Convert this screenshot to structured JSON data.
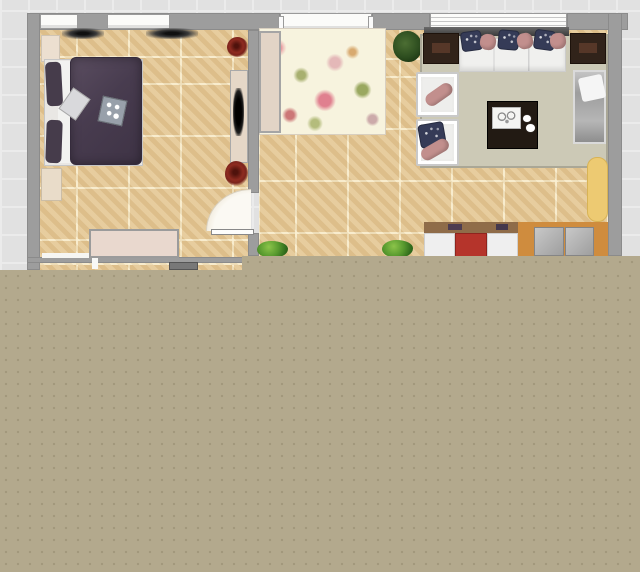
{
  "canvas": {
    "width": 640,
    "height": 572
  },
  "colors": {
    "background": "#e1e1e1",
    "background_grid": "#ebebeb",
    "wall": "#9d9d9d",
    "floor_tile": "#e4c795",
    "tile_grout": "#faeece",
    "unrendered_area": "#b3a98d",
    "unrendered_dots": "#a1977b",
    "bed_duvet": "#483c4f",
    "sofa_white": "#f0f0ee",
    "pillow_navy": "#353b57",
    "pillow_pink": "#c28f8d",
    "cabinet_red": "#b5342b",
    "counter_wood": "#cf8c3e",
    "board_yellow": "#edca72",
    "rug_sage": "#ccc9b6",
    "rug_floral_base": "#f7f3de"
  },
  "layers": [
    {
      "name": "floors",
      "items": [
        {
          "n": "bedroom-floor",
          "c": "tile",
          "x": 40,
          "y": 28,
          "w": 208,
          "h": 235,
          "int": false
        },
        {
          "n": "living-room-floor",
          "c": "tile",
          "x": 259,
          "y": 30,
          "w": 349,
          "h": 226,
          "int": false
        },
        {
          "n": "hallway-floor-sliver",
          "c": "tile",
          "x": 40,
          "y": 263,
          "w": 208,
          "h": 7,
          "int": false
        }
      ]
    },
    {
      "name": "walls",
      "items": [
        {
          "n": "left-wall",
          "c": "wall",
          "x": 27,
          "y": 13,
          "w": 13,
          "h": 257,
          "int": false
        },
        {
          "n": "top-wall-bedroom",
          "c": "wall",
          "x": 40,
          "y": 13,
          "w": 240,
          "h": 17,
          "int": false
        },
        {
          "n": "top-wall-living",
          "c": "wall",
          "x": 372,
          "y": 13,
          "w": 58,
          "h": 17,
          "int": false
        },
        {
          "n": "top-wall-right",
          "c": "wall",
          "x": 567,
          "y": 13,
          "w": 61,
          "h": 17,
          "int": false
        },
        {
          "n": "right-wall",
          "c": "wall",
          "x": 608,
          "y": 13,
          "w": 14,
          "h": 243,
          "int": false
        },
        {
          "n": "divider-wall-upper",
          "c": "wall",
          "x": 248,
          "y": 30,
          "w": 11,
          "h": 163,
          "int": false
        },
        {
          "n": "divider-wall-lower",
          "c": "wall",
          "x": 248,
          "y": 233,
          "w": 11,
          "h": 23,
          "int": false
        },
        {
          "n": "bedroom-bottom-wall",
          "c": "wall",
          "x": 27,
          "y": 257,
          "w": 221,
          "h": 6,
          "int": false
        }
      ]
    },
    {
      "name": "windows",
      "items": [
        {
          "n": "corner-window",
          "c": "window",
          "x": 40,
          "y": 14,
          "w": 38,
          "h": 15,
          "int": false
        },
        {
          "n": "bedroom-window",
          "c": "window",
          "x": 107,
          "y": 14,
          "w": 63,
          "h": 15,
          "int": false
        },
        {
          "n": "living-window-left",
          "c": "window",
          "x": 280,
          "y": 13,
          "w": 92,
          "h": 17,
          "int": false
        },
        {
          "n": "living-window-wide",
          "c": "window-lined",
          "x": 430,
          "y": 13,
          "w": 137,
          "h": 17,
          "int": false
        },
        {
          "n": "window-peg-left",
          "x": 278,
          "y": 16,
          "w": 6,
          "h": 17,
          "bg": "#fafafa",
          "bd": "1px solid #9a9a9a",
          "int": false
        },
        {
          "n": "window-peg-right",
          "x": 368,
          "y": 16,
          "w": 6,
          "h": 17,
          "bg": "#fafafa",
          "bd": "1px solid #9a9a9a",
          "int": false
        },
        {
          "n": "bedroom-low-window",
          "x": 42,
          "y": 253,
          "w": 47,
          "h": 5,
          "bg": "#f6f6f3",
          "int": false
        },
        {
          "n": "bottom-door-jamb",
          "x": 92,
          "y": 257,
          "w": 6,
          "h": 12,
          "bg": "#f8f8f6",
          "int": false
        }
      ]
    },
    {
      "name": "bedroom-furniture",
      "items": [
        {
          "n": "ceiling-lamp-left",
          "c": "sconce",
          "x": 62,
          "y": 28,
          "w": 42,
          "h": 11,
          "int": true
        },
        {
          "n": "ceiling-lamp-right",
          "c": "sconce",
          "x": 146,
          "y": 28,
          "w": 52,
          "h": 11,
          "int": true
        },
        {
          "n": "cream-cabinet",
          "x": 41,
          "y": 35,
          "w": 19,
          "h": 27,
          "bg": "#ecdfd0",
          "bd": "1px solid #cfc4b4",
          "int": true
        },
        {
          "n": "bed-mattress",
          "x": 44,
          "y": 59,
          "w": 99,
          "h": 107,
          "bg": "#e9e7e4",
          "bd": "1px solid #c6c6c6",
          "int": true
        },
        {
          "n": "bed-sheet",
          "x": 58,
          "y": 61,
          "w": 20,
          "h": 102,
          "bg": "#f2f2f0",
          "int": false
        },
        {
          "n": "bed-pillow-top",
          "x": 46,
          "y": 62,
          "w": 16,
          "h": 44,
          "bg": "#463c4b",
          "rad": "5px",
          "rot": -3,
          "int": true
        },
        {
          "n": "bed-pillow-bottom",
          "x": 46,
          "y": 120,
          "w": 16,
          "h": 43,
          "bg": "#463c4b",
          "rad": "5px",
          "rot": 2,
          "int": true
        },
        {
          "n": "bed-duvet",
          "c": "duvet",
          "x": 70,
          "y": 57,
          "w": 72,
          "h": 108,
          "int": true
        },
        {
          "n": "bed-diamond-pillow",
          "x": 64,
          "y": 91,
          "w": 21,
          "h": 26,
          "bg": "#d9d9dc",
          "bd": "1px solid #a8a8a8",
          "rot": 35,
          "int": true
        },
        {
          "n": "game-board",
          "c": "dots-board",
          "x": 100,
          "y": 98,
          "w": 25,
          "h": 26,
          "bg": "#98a0aa",
          "bd": "1px solid #6a7076",
          "rot": 12,
          "int": true
        },
        {
          "n": "nightstand",
          "x": 41,
          "y": 168,
          "w": 21,
          "h": 33,
          "bg": "#e9dcc9",
          "bd": "1px solid #cbbda6",
          "int": true
        },
        {
          "n": "console-table",
          "x": 230,
          "y": 70,
          "w": 18,
          "h": 93,
          "bg": "#e5d7c7",
          "bd": "1px solid #a9a9a9",
          "int": true
        },
        {
          "n": "black-vase",
          "c": "vase",
          "x": 233,
          "y": 88,
          "w": 11,
          "h": 48,
          "int": true
        },
        {
          "n": "red-flower-top",
          "c": "flower",
          "x": 227,
          "y": 37,
          "w": 21,
          "h": 20,
          "int": true
        },
        {
          "n": "red-flower-mid",
          "c": "flower",
          "x": 225,
          "y": 161,
          "w": 23,
          "h": 25,
          "int": true
        },
        {
          "n": "dresser",
          "x": 89,
          "y": 229,
          "w": 90,
          "h": 29,
          "bg": "#e9d8ce",
          "bd": "2px solid #9b9b9b",
          "int": true
        },
        {
          "n": "door-swing-arc",
          "c": "door-arc",
          "x": 206,
          "y": 189,
          "w": 45,
          "h": 42,
          "int": false
        },
        {
          "n": "door-leaf",
          "x": 211,
          "y": 229,
          "w": 43,
          "h": 6,
          "bg": "#fdfdfb",
          "bd": "1px solid #888",
          "int": true
        }
      ]
    },
    {
      "name": "living-furniture",
      "items": [
        {
          "n": "floral-rug",
          "c": "floral",
          "x": 259,
          "y": 28,
          "w": 127,
          "h": 107,
          "bd": "1px solid #d8cfc0",
          "int": true
        },
        {
          "n": "side-panel",
          "x": 259,
          "y": 31,
          "w": 22,
          "h": 102,
          "bg": "#e2d4c6",
          "bd": "2px solid #a5a5a5",
          "int": true
        },
        {
          "n": "potted-plant-top",
          "c": "plant-dark",
          "x": 393,
          "y": 31,
          "w": 29,
          "h": 31,
          "int": true
        },
        {
          "n": "sage-rug",
          "x": 420,
          "y": 34,
          "w": 188,
          "h": 134,
          "bg": "#ccc9b6",
          "bd": "2px solid #aaa796",
          "int": true
        },
        {
          "n": "sofa-back-rail",
          "c": "rail",
          "x": 424,
          "y": 27,
          "w": 145,
          "h": 9,
          "int": false
        },
        {
          "n": "end-table-left",
          "c": "endtable",
          "x": 423,
          "y": 33,
          "w": 36,
          "h": 31,
          "int": true
        },
        {
          "n": "end-table-right",
          "c": "endtable",
          "x": 570,
          "y": 33,
          "w": 36,
          "h": 31,
          "int": true
        },
        {
          "n": "sofa",
          "c": "sofa",
          "x": 459,
          "y": 38,
          "w": 107,
          "h": 34,
          "int": true
        },
        {
          "n": "sofa-pillow-navy-1",
          "c": "pillow-navy",
          "x": 461,
          "y": 31,
          "w": 21,
          "h": 20,
          "rot": -8,
          "int": true
        },
        {
          "n": "sofa-pillow-pink-1",
          "c": "pillow-pink",
          "x": 480,
          "y": 34,
          "w": 16,
          "h": 16,
          "rot": 10,
          "int": true
        },
        {
          "n": "sofa-pillow-navy-2",
          "c": "pillow-navy",
          "x": 498,
          "y": 30,
          "w": 21,
          "h": 20,
          "rot": 5,
          "int": true
        },
        {
          "n": "sofa-pillow-pink-2",
          "c": "pillow-pink",
          "x": 517,
          "y": 33,
          "w": 16,
          "h": 16,
          "rot": -12,
          "int": true
        },
        {
          "n": "sofa-pillow-navy-3",
          "c": "pillow-navy",
          "x": 534,
          "y": 30,
          "w": 21,
          "h": 20,
          "rot": 8,
          "int": true
        },
        {
          "n": "sofa-pillow-pink-3",
          "c": "pillow-pink",
          "x": 550,
          "y": 33,
          "w": 16,
          "h": 16,
          "rot": -5,
          "int": true
        },
        {
          "n": "armchair-top",
          "c": "chair",
          "x": 416,
          "y": 72,
          "w": 43,
          "h": 45,
          "int": true
        },
        {
          "n": "armchair-top-bolster",
          "c": "pillow-pink",
          "x": 424,
          "y": 88,
          "w": 30,
          "h": 13,
          "rot": -35,
          "int": true
        },
        {
          "n": "armchair-bottom",
          "c": "chair",
          "x": 416,
          "y": 119,
          "w": 43,
          "h": 47,
          "int": true
        },
        {
          "n": "armchair-bottom-pillow",
          "c": "pillow-navy",
          "x": 419,
          "y": 123,
          "w": 26,
          "h": 24,
          "rot": -10,
          "int": true
        },
        {
          "n": "armchair-bottom-bolster",
          "c": "pillow-pink",
          "x": 420,
          "y": 143,
          "w": 30,
          "h": 13,
          "rot": -30,
          "int": true
        },
        {
          "n": "coffee-table",
          "x": 487,
          "y": 101,
          "w": 51,
          "h": 48,
          "bg": "#221a13",
          "bd": "1px solid #000",
          "int": true
        },
        {
          "n": "coffee-table-tray",
          "c": "tray",
          "x": 492,
          "y": 107,
          "w": 29,
          "h": 22,
          "int": true
        },
        {
          "n": "tray-cup-1",
          "c": "white-dot",
          "x": 523,
          "y": 115,
          "w": 8,
          "h": 7,
          "int": false
        },
        {
          "n": "tray-cup-2",
          "c": "white-dot",
          "x": 526,
          "y": 124,
          "w": 9,
          "h": 8,
          "int": false
        },
        {
          "n": "daybed",
          "c": "daybed",
          "x": 573,
          "y": 70,
          "w": 33,
          "h": 74,
          "int": true
        },
        {
          "n": "daybed-pillow",
          "x": 580,
          "y": 76,
          "w": 24,
          "h": 24,
          "bg": "#f5f5f5",
          "rad": "3px",
          "rot": -12,
          "int": true
        },
        {
          "n": "yellow-board",
          "x": 587,
          "y": 157,
          "w": 21,
          "h": 65,
          "bg": "#edca72",
          "bd": "1px solid #d8b355",
          "rad": "10px",
          "int": true
        },
        {
          "n": "kitchen-counter-top",
          "x": 424,
          "y": 222,
          "w": 94,
          "h": 11,
          "bg": "#8f6c49",
          "int": true
        },
        {
          "n": "counter-clutter-1",
          "x": 448,
          "y": 224,
          "w": 14,
          "h": 6,
          "bg": "#4d3c50",
          "int": false
        },
        {
          "n": "counter-clutter-2",
          "x": 496,
          "y": 224,
          "w": 12,
          "h": 6,
          "bg": "#45384c",
          "int": false
        },
        {
          "n": "cabinet-white-left",
          "x": 424,
          "y": 233,
          "w": 31,
          "h": 25,
          "bg": "#efefef",
          "bd": "1px solid #cfcfcf",
          "int": true
        },
        {
          "n": "cabinet-red",
          "x": 455,
          "y": 233,
          "w": 32,
          "h": 25,
          "bg": "#b5342b",
          "bd": "1px solid #8f241e",
          "int": true
        },
        {
          "n": "cabinet-white-right",
          "x": 487,
          "y": 233,
          "w": 31,
          "h": 25,
          "bg": "#efefef",
          "bd": "1px solid #cfcfcf",
          "int": true
        },
        {
          "n": "wood-counter",
          "x": 518,
          "y": 222,
          "w": 90,
          "h": 36,
          "bg": "#cf8c3e",
          "int": true
        },
        {
          "n": "stool-left",
          "c": "stool",
          "x": 534,
          "y": 227,
          "w": 30,
          "h": 29,
          "int": true
        },
        {
          "n": "stool-right",
          "c": "stool",
          "x": 565,
          "y": 227,
          "w": 29,
          "h": 29,
          "int": true
        },
        {
          "n": "bush-left",
          "c": "plant",
          "x": 257,
          "y": 241,
          "w": 31,
          "h": 17,
          "int": true
        },
        {
          "n": "bush-right",
          "c": "plant",
          "x": 382,
          "y": 240,
          "w": 31,
          "h": 18,
          "int": true
        }
      ]
    },
    {
      "name": "lower-sliver",
      "items": [
        {
          "n": "appliance",
          "x": 169,
          "y": 262,
          "w": 29,
          "h": 8,
          "bg": "#787878",
          "bd": "1px solid #555",
          "int": true
        }
      ]
    },
    {
      "name": "overlay",
      "items": [
        {
          "n": "unrendered-area-right",
          "c": "unrendered",
          "x": 242,
          "y": 256,
          "w": 398,
          "h": 316,
          "int": false
        },
        {
          "n": "unrendered-area-bottom",
          "c": "unrendered",
          "x": 0,
          "y": 270,
          "w": 640,
          "h": 302,
          "int": false
        }
      ]
    }
  ]
}
